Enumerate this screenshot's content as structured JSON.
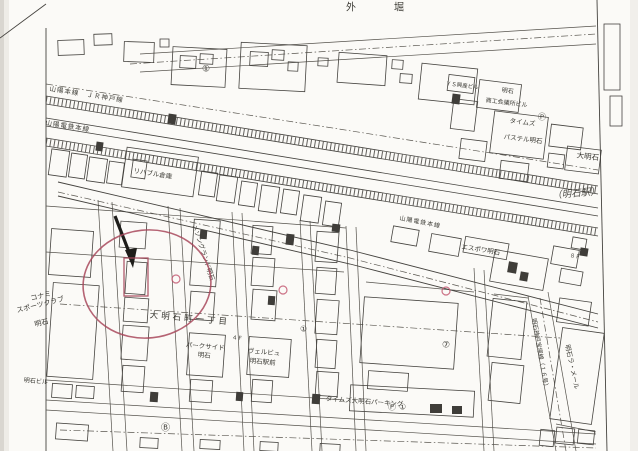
{
  "colors": {
    "paper": "#fbfaf7",
    "ink": "#45433f",
    "ink_light": "#7d7a72",
    "annotation_red": "#a8485c",
    "handwriting_red": "#c0506a"
  },
  "map": {
    "labels": [
      {
        "id": "outer-moat",
        "text": "外　堀",
        "x": 346,
        "y": 4,
        "rot": 0,
        "size": 10,
        "sp": 14
      },
      {
        "id": "rail-jr-sanyo-line",
        "text": "山陽本線　ＪＲ神戸線",
        "x": 50,
        "y": 86,
        "rot": 9,
        "size": 6.5,
        "sp": 1
      },
      {
        "id": "rail-sanyo-dentetsu-west",
        "text": "山陽電鉄本線",
        "x": 46,
        "y": 120,
        "rot": 9,
        "size": 6.5,
        "sp": 1
      },
      {
        "id": "rail-sanyo-dentetsu-east",
        "text": "山陽電鉄本線",
        "x": 400,
        "y": 216,
        "rot": 11,
        "size": 6,
        "sp": 1
      },
      {
        "id": "rehab-warehouse",
        "text": "リハブル倉庫",
        "x": 134,
        "y": 168,
        "rot": 9,
        "size": 6.5,
        "sp": 0
      },
      {
        "id": "maison-grand-akashi",
        "text": "メゾングランド明石",
        "x": 197,
        "y": 224,
        "rot": 72,
        "size": 6.5,
        "sp": 0
      },
      {
        "id": "konami-line1",
        "text": "コナミ",
        "x": 30,
        "y": 296,
        "rot": -14,
        "size": 7,
        "sp": 0
      },
      {
        "id": "konami-line2",
        "text": "スポーツクラブ",
        "x": 16,
        "y": 308,
        "rot": -14,
        "size": 7,
        "sp": 0
      },
      {
        "id": "konami-line3",
        "text": "明石",
        "x": 34,
        "y": 322,
        "rot": -14,
        "size": 7,
        "sp": 0
      },
      {
        "id": "district-oakashicho-1chome",
        "text": "大明石町一丁目",
        "x": 150,
        "y": 312,
        "rot": 5,
        "size": 8.5,
        "sp": 3
      },
      {
        "id": "parkside-line1",
        "text": "パークサイド",
        "x": 186,
        "y": 342,
        "rot": 5,
        "size": 6.5,
        "sp": 0
      },
      {
        "id": "parkside-line2",
        "text": "明石",
        "x": 198,
        "y": 352,
        "rot": 5,
        "size": 6.5,
        "sp": 0
      },
      {
        "id": "velbu-line1",
        "text": "ヴェルビュ",
        "x": 248,
        "y": 348,
        "rot": 5,
        "size": 6.5,
        "sp": 0
      },
      {
        "id": "velbu-line2",
        "text": "明石駅前",
        "x": 250,
        "y": 358,
        "rot": 5,
        "size": 6.5,
        "sp": 0
      },
      {
        "id": "akashi-building",
        "text": "明石ビル",
        "x": 24,
        "y": 378,
        "rot": 5,
        "size": 6,
        "sp": 0
      },
      {
        "id": "espoir-akashi",
        "text": "エスポワ明石",
        "x": 462,
        "y": 244,
        "rot": 9,
        "size": 6.5,
        "sp": 0
      },
      {
        "id": "ys-kosan-building",
        "text": "ＹＳ興産ビル",
        "x": 446,
        "y": 82,
        "rot": 7,
        "size": 5.5,
        "sp": 0
      },
      {
        "id": "cci-line1",
        "text": "明石",
        "x": 502,
        "y": 88,
        "rot": 7,
        "size": 6,
        "sp": 0
      },
      {
        "id": "cci-line2",
        "text": "商工会議所ビル",
        "x": 486,
        "y": 98,
        "rot": 7,
        "size": 6,
        "sp": 0
      },
      {
        "id": "times-plaza",
        "text": "タイムズ",
        "x": 510,
        "y": 118,
        "rot": 7,
        "size": 6.5,
        "sp": 0
      },
      {
        "id": "pastel-akashi",
        "text": "パステル明石",
        "x": 504,
        "y": 134,
        "rot": 7,
        "size": 6.5,
        "sp": 0
      },
      {
        "id": "times-oakashi-parking",
        "text": "タイムズ大明石パーキング",
        "x": 326,
        "y": 396,
        "rot": 4,
        "size": 6.5,
        "sp": 0
      },
      {
        "id": "la-mer-akashi",
        "text": "明石ラ・メール",
        "x": 570,
        "y": 344,
        "rot": 78,
        "size": 6.5,
        "sp": 0
      },
      {
        "id": "route16-akashi-kobe-takarazuka",
        "text": "明石神戸宝塚線（１６号）",
        "x": 536,
        "y": 318,
        "rot": 80,
        "size": 6,
        "sp": 0
      },
      {
        "id": "oakashi-edge-box",
        "text": "大明石",
        "x": 577,
        "y": 152,
        "rot": 7,
        "size": 7.5,
        "sp": 0
      },
      {
        "id": "floor-8f",
        "text": "８Ｆ",
        "x": 570,
        "y": 254,
        "rot": 9,
        "size": 5.5,
        "sp": 0
      },
      {
        "id": "floor-4f",
        "text": "４Ｆ",
        "x": 232,
        "y": 336,
        "rot": 5,
        "size": 5.5,
        "sp": 0
      }
    ],
    "symbols": [
      {
        "id": "circled-1-block",
        "text": "①",
        "x": 202,
        "y": 66,
        "size": 9
      },
      {
        "id": "circled-1-district",
        "text": "①",
        "x": 300,
        "y": 326,
        "size": 8
      },
      {
        "id": "circled-7-parking",
        "text": "⑦",
        "x": 442,
        "y": 342,
        "size": 9
      },
      {
        "id": "circled-b-busstop",
        "text": "Ⓑ",
        "x": 161,
        "y": 425,
        "size": 9
      },
      {
        "id": "parking-p-times-plaza",
        "text": "Ⓟ",
        "x": 538,
        "y": 114,
        "size": 8
      },
      {
        "id": "parking-p-lot",
        "text": "Ⓟ",
        "x": 388,
        "y": 404,
        "size": 8
      },
      {
        "id": "circled-1-lot",
        "text": "①",
        "x": 399,
        "y": 404,
        "size": 8
      }
    ],
    "annotations": {
      "handwriting": {
        "text": "（明石駅）",
        "x": 552,
        "y": 192,
        "rot": -5,
        "size": 9.5
      },
      "target_circle": {
        "cx": 147,
        "cy": 284,
        "rx": 64,
        "ry": 54,
        "rot": -6
      },
      "target_box": {
        "x": 124,
        "y": 258,
        "w": 24,
        "h": 38
      },
      "small_circles": [
        {
          "x": 176,
          "y": 279
        },
        {
          "x": 283,
          "y": 290
        },
        {
          "x": 446,
          "y": 291
        }
      ]
    }
  }
}
